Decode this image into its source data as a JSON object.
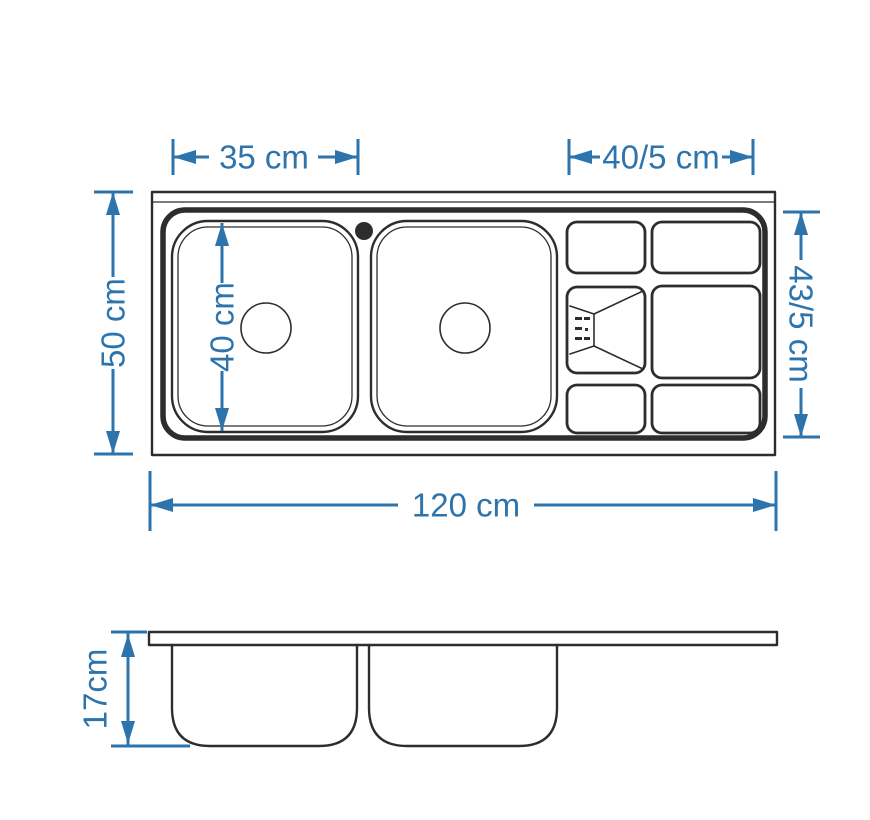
{
  "colors": {
    "dimension": "#2e74ac",
    "line": "#2d2d2d",
    "background": "#ffffff"
  },
  "drawing": {
    "views": {
      "top": {
        "dimensions": {
          "bowl_width": "35 cm",
          "drainboard_width": "40/5 cm",
          "overall_depth": "50 cm",
          "bowl_depth": "40 cm",
          "drainboard_depth": "43/5 cm",
          "overall_length": "120 cm"
        }
      },
      "side": {
        "dimensions": {
          "height": "17cm"
        }
      }
    }
  }
}
